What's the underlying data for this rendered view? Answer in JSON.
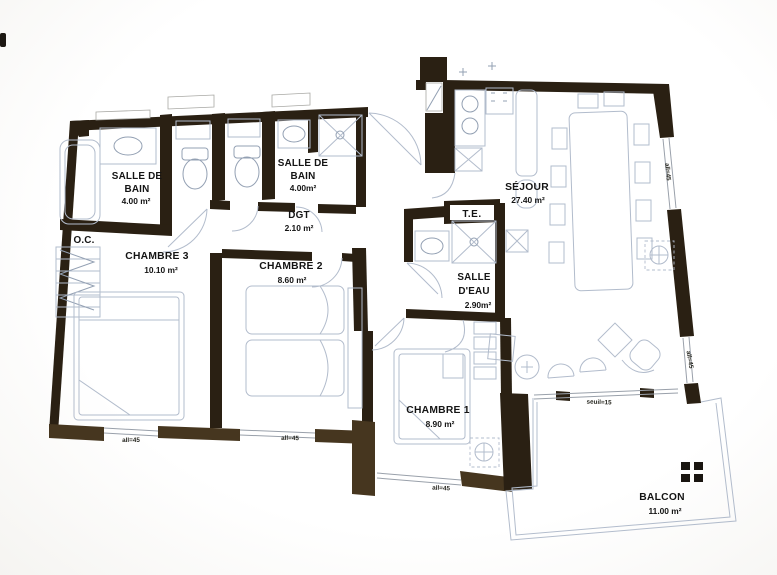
{
  "meta": {
    "type": "apartment-floor-plan",
    "description": "Scanned architectural floor plan of a 3-bedroom apartment with balcony"
  },
  "colors": {
    "wall": "#2a2013",
    "wall_faded": "#46361f",
    "fixture": "#b2bccc",
    "fixture_dark": "#93a0b3",
    "sill": "#99a0aa",
    "text": "#141414",
    "bg": "#ffffff"
  },
  "rooms": {
    "sdb1": {
      "l1": "SALLE DE",
      "l2": "BAIN",
      "area": "4.00 m²"
    },
    "sdb2": {
      "l1": "SALLE DE",
      "l2": "BAIN",
      "area": "4.00m²"
    },
    "dgt": {
      "name": "DGT",
      "area": "2.10 m²"
    },
    "oc": {
      "name": "O.C."
    },
    "ch3": {
      "name": "CHAMBRE 3",
      "area": "10.10 m²"
    },
    "ch2": {
      "name": "CHAMBRE 2",
      "area": "8.60 m²"
    },
    "te": {
      "name": "T.E."
    },
    "sde": {
      "l1": "SALLE",
      "l2": "D'EAU",
      "area": "2.90m²"
    },
    "sejour": {
      "name": "SÉJOUR",
      "area": "27.40 m²"
    },
    "ch1": {
      "name": "CHAMBRE 1",
      "area": "8.90 m²"
    },
    "balcon": {
      "name": "BALCON",
      "area": "11.00 m²"
    }
  },
  "annotations": {
    "allege_ch3": "all=45",
    "allege_ch2": "all=45",
    "allege_ch1": "all=45",
    "allege_sejour_upper": "all=45",
    "allege_sejour_lower": "all=45",
    "seuil_balcon": "seuil=15"
  }
}
